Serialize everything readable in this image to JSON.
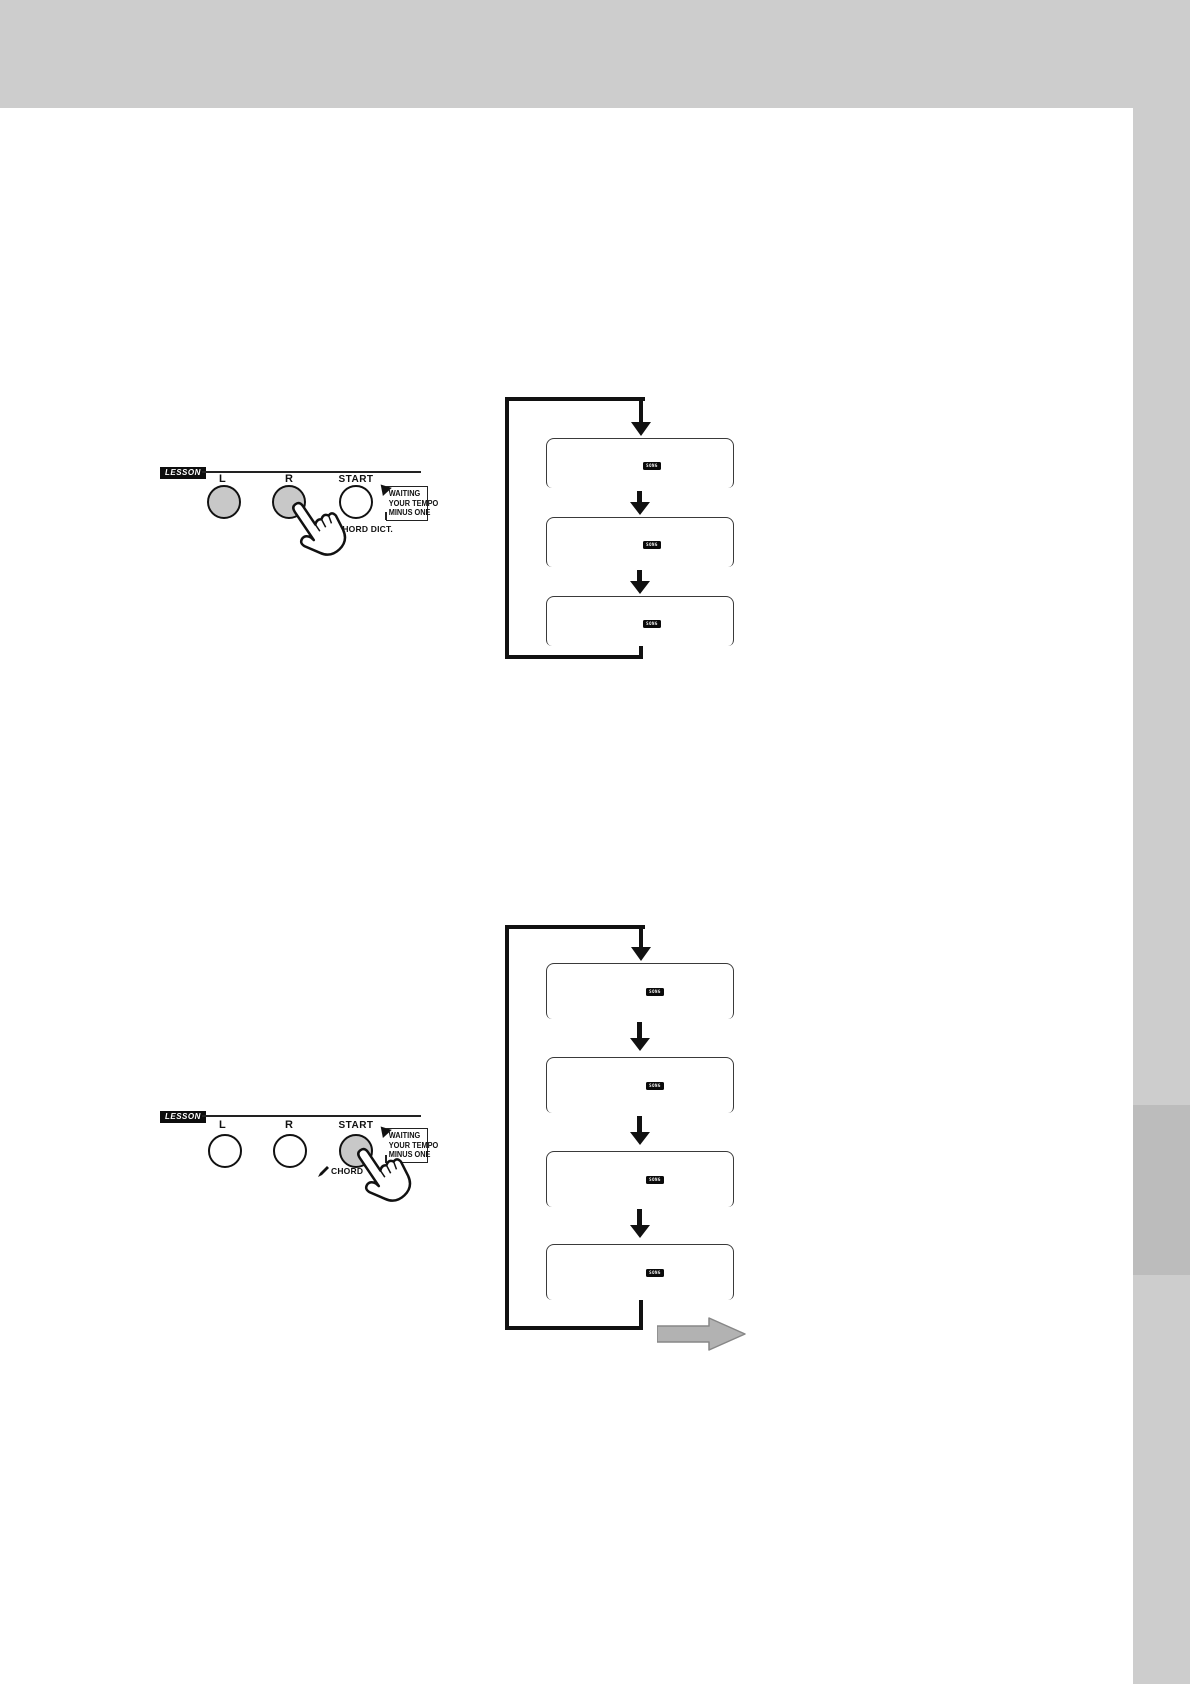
{
  "page": {
    "colors": {
      "top_band": "#cdcdcd",
      "right_strip": "#cdcdcd",
      "chapter_tab": "#bcbcbc",
      "pressed_button_fill": "#c8c8c8",
      "page_turn_arrow": "#b2b2b2"
    },
    "icons": {
      "hand_cursor_icon": "pointing-hand",
      "pencil_icon": "pencil",
      "page_turn_arrow_icon": "right-arrow"
    }
  },
  "lesson_panels": [
    {
      "label": "LESSON",
      "buttons": {
        "l": "L",
        "r": "R",
        "start": "START"
      },
      "chord_label": "CHORD DICT.",
      "callout": {
        "lines": [
          "WAITING",
          "YOUR TEMPO",
          "MINUS ONE"
        ]
      }
    },
    {
      "label": "LESSON",
      "buttons": {
        "l": "L",
        "r": "R",
        "start": "START"
      },
      "chord_label": "CHORD",
      "callout": {
        "lines": [
          "WAITING",
          "YOUR TEMPO",
          "MINUS ONE"
        ]
      }
    }
  ],
  "flowcharts": [
    {
      "boxes": [
        {
          "badge": "SONG"
        },
        {
          "badge": "SONG"
        },
        {
          "badge": "SONG"
        }
      ]
    },
    {
      "boxes": [
        {
          "badge": "SONG"
        },
        {
          "badge": "SONG"
        },
        {
          "badge": "SONG"
        },
        {
          "badge": "SONG"
        }
      ]
    }
  ]
}
